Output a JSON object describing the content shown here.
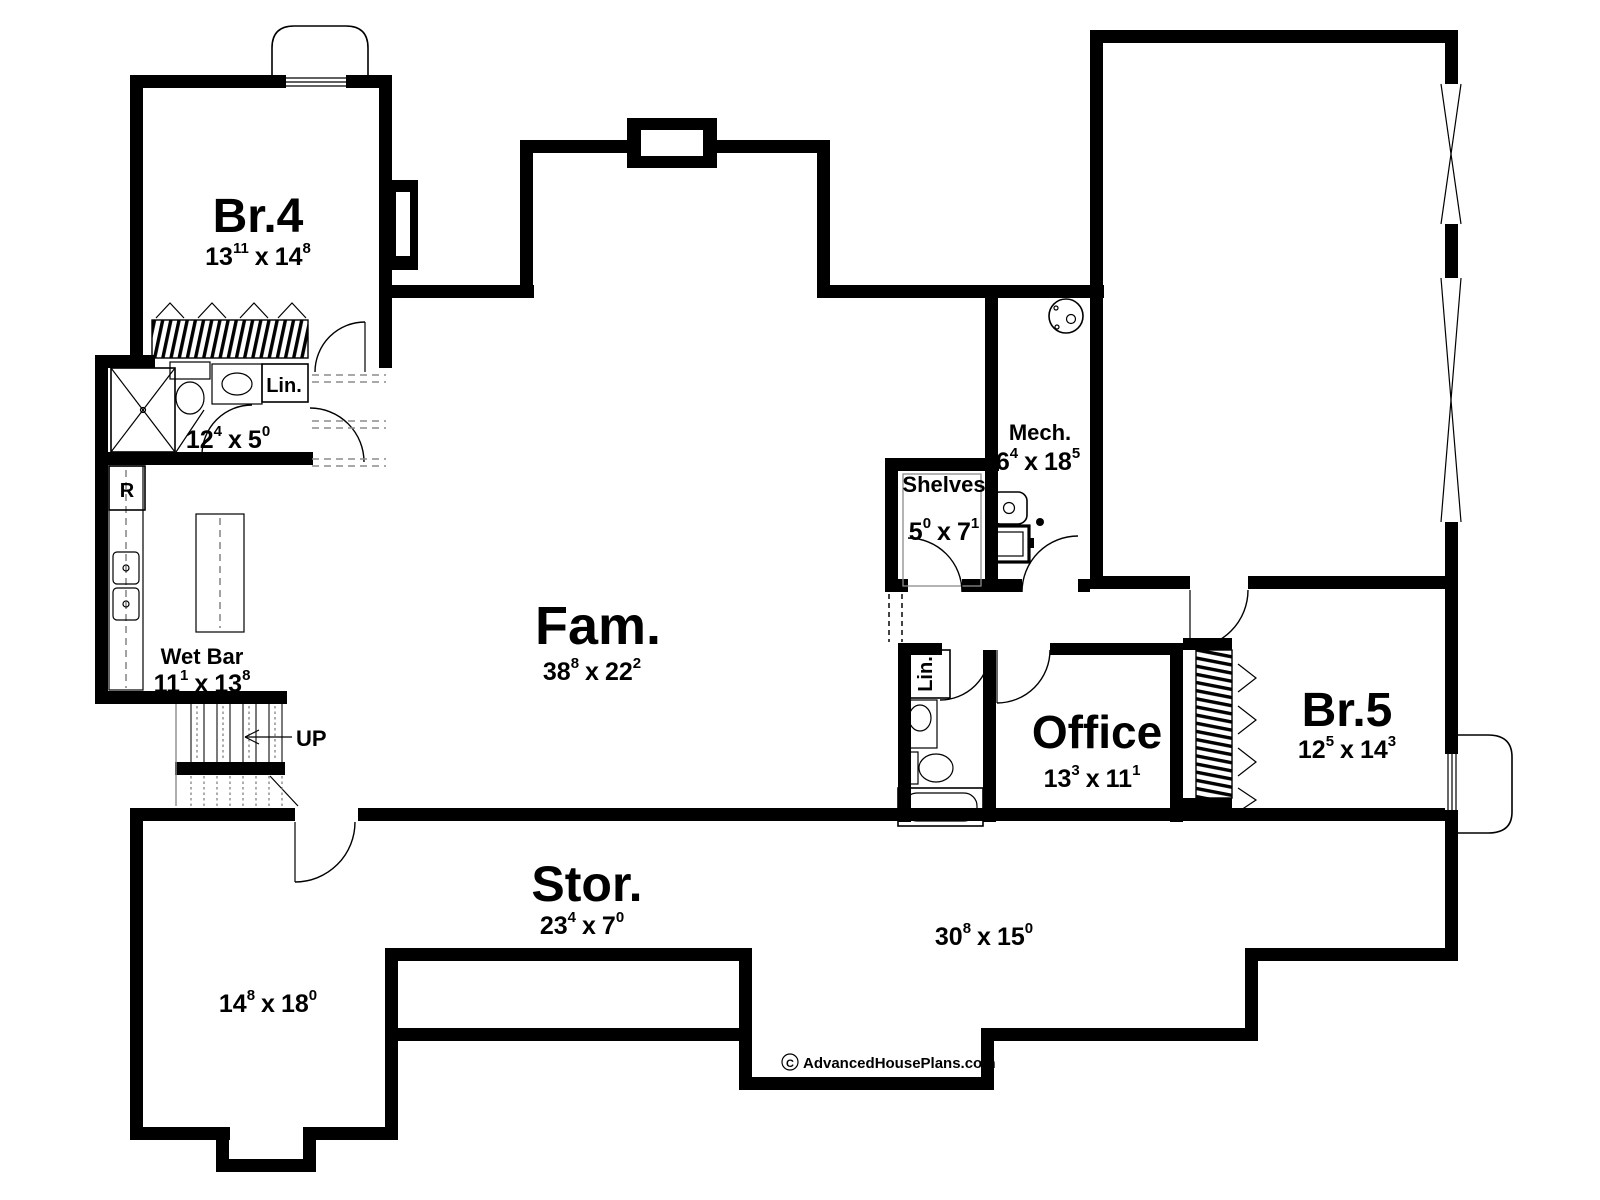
{
  "plan": {
    "title": "Basement floor plan",
    "rooms": {
      "br4": {
        "name": "Br.4",
        "dim": {
          "a": "13",
          "asup": "11",
          "b": "14",
          "bsup": "8"
        }
      },
      "bath": {
        "dim": {
          "a": "12",
          "asup": "4",
          "b": "5",
          "bsup": "0"
        }
      },
      "wet_bar": {
        "name": "Wet Bar",
        "dim": {
          "a": "11",
          "asup": "1",
          "b": "13",
          "bsup": "8"
        }
      },
      "fam": {
        "name": "Fam.",
        "dim": {
          "a": "38",
          "asup": "8",
          "b": "22",
          "bsup": "2"
        }
      },
      "mech": {
        "name": "Mech.",
        "dim": {
          "a": "6",
          "asup": "4",
          "b": "18",
          "bsup": "5"
        }
      },
      "shelves": {
        "name": "Shelves",
        "dim": {
          "a": "5",
          "asup": "0",
          "b": "7",
          "bsup": "1"
        }
      },
      "office": {
        "name": "Office",
        "dim": {
          "a": "13",
          "asup": "3",
          "b": "11",
          "bsup": "1"
        }
      },
      "br5": {
        "name": "Br.5",
        "dim": {
          "a": "12",
          "asup": "5",
          "b": "14",
          "bsup": "3"
        }
      },
      "stor": {
        "name": "Stor.",
        "dim": {
          "a": "23",
          "asup": "4",
          "b": "7",
          "bsup": "0"
        }
      },
      "stor_right": {
        "dim": {
          "a": "30",
          "asup": "8",
          "b": "15",
          "bsup": "0"
        }
      },
      "stor_left": {
        "dim": {
          "a": "14",
          "asup": "8",
          "b": "18",
          "bsup": "0"
        }
      },
      "linen_bath": {
        "name": "Lin."
      },
      "linen_hall": {
        "name": "Lin."
      }
    },
    "labels": {
      "up": "UP",
      "fridge": "R",
      "dim_sep": "x"
    },
    "footer": {
      "symbol": "C",
      "credit": "AdvancedHousePlans.com"
    },
    "colors": {
      "wall": "#000000",
      "background": "#ffffff",
      "light_line": "#8c8c8c"
    }
  }
}
